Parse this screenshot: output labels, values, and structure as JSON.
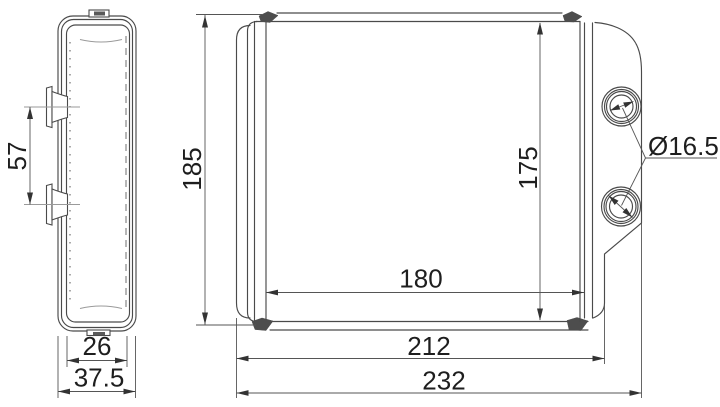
{
  "drawing": {
    "type": "technical-dimension-drawing",
    "part": "heater-core",
    "side_view": {
      "port_spacing": "57",
      "face_width": "26",
      "overall_depth": "37.5"
    },
    "front_view": {
      "overall_height": "185",
      "core_height": "175",
      "core_width": "180",
      "body_width": "212",
      "overall_width": "232",
      "port_diameter": "Ø16.5"
    }
  },
  "colors": {
    "background": "#ffffff",
    "line": "#4a4a4a",
    "text": "#1e1e1e",
    "centerline": "#9a9a9a"
  }
}
